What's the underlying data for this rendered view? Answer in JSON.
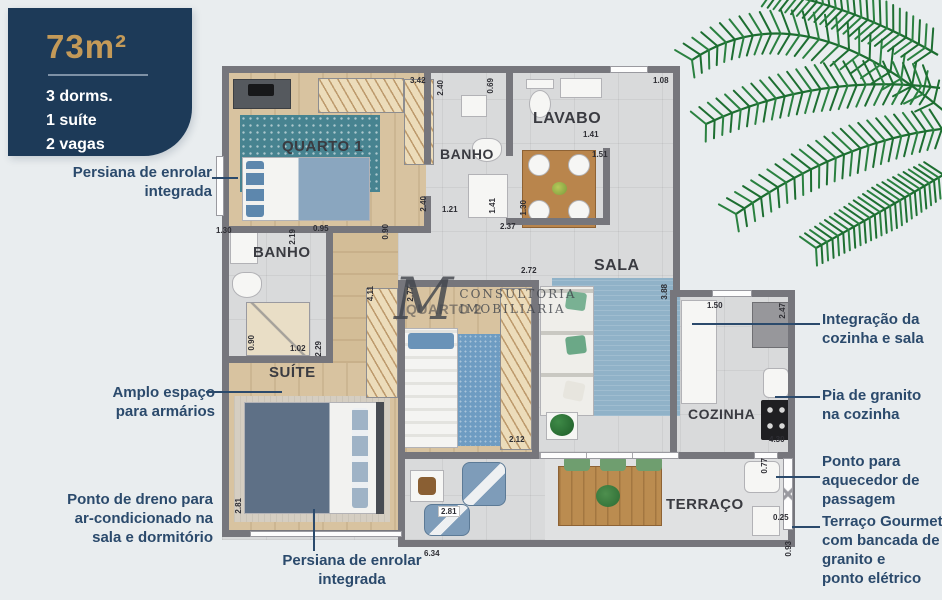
{
  "info_card": {
    "area_label": "73m²",
    "specs": [
      "3 dorms.",
      "1 suíte",
      "2 vagas"
    ]
  },
  "watermark": {
    "monogram": "M",
    "line1": "CONSULTORIA",
    "line2": "IMOBILIARIA"
  },
  "room_labels": [
    {
      "id": "quarto1",
      "text": "QUARTO 1",
      "x": 282,
      "y": 138,
      "size": 15
    },
    {
      "id": "banho-social",
      "text": "BANHO",
      "x": 440,
      "y": 146,
      "size": 14
    },
    {
      "id": "lavabo",
      "text": "LAVABO",
      "x": 533,
      "y": 110,
      "size": 16
    },
    {
      "id": "sala",
      "text": "SALA",
      "x": 594,
      "y": 257,
      "size": 16
    },
    {
      "id": "banho-suite",
      "text": "BANHO",
      "x": 253,
      "y": 244,
      "size": 15
    },
    {
      "id": "suite",
      "text": "SUÍTE",
      "x": 269,
      "y": 364,
      "size": 15
    },
    {
      "id": "quarto2",
      "text": "QUARTO 2",
      "x": 406,
      "y": 301,
      "size": 14,
      "faded": true
    },
    {
      "id": "cozinha",
      "text": "COZINHA",
      "x": 688,
      "y": 406,
      "size": 14
    },
    {
      "id": "terraco",
      "text": "TERRAÇO",
      "x": 666,
      "y": 496,
      "size": 15
    }
  ],
  "dimensions": [
    {
      "v": "3.42",
      "x": 410,
      "y": 76
    },
    {
      "v": "2.40",
      "x": 436,
      "y": 80,
      "r": 1
    },
    {
      "v": "0.69",
      "x": 486,
      "y": 78,
      "r": 1
    },
    {
      "v": "1.08",
      "x": 653,
      "y": 76
    },
    {
      "v": "1.41",
      "x": 583,
      "y": 130
    },
    {
      "v": "1.51",
      "x": 592,
      "y": 150
    },
    {
      "v": "2.40",
      "x": 419,
      "y": 196,
      "r": 1
    },
    {
      "v": "1.21",
      "x": 442,
      "y": 205
    },
    {
      "v": "1.41",
      "x": 488,
      "y": 198,
      "r": 1
    },
    {
      "v": "2.37",
      "x": 500,
      "y": 222
    },
    {
      "v": "1.30",
      "x": 519,
      "y": 200,
      "r": 1
    },
    {
      "v": "1.30",
      "x": 216,
      "y": 226
    },
    {
      "v": "2.19",
      "x": 288,
      "y": 229,
      "r": 1
    },
    {
      "v": "0.95",
      "x": 313,
      "y": 224
    },
    {
      "v": "0.90",
      "x": 381,
      "y": 224,
      "r": 1
    },
    {
      "v": "0.90",
      "x": 247,
      "y": 335,
      "r": 1
    },
    {
      "v": "1.02",
      "x": 290,
      "y": 344
    },
    {
      "v": "2.29",
      "x": 314,
      "y": 341,
      "r": 1
    },
    {
      "v": "4.11",
      "x": 366,
      "y": 286,
      "r": 1
    },
    {
      "v": "2.77",
      "x": 406,
      "y": 286,
      "r": 1
    },
    {
      "v": "2.72",
      "x": 521,
      "y": 266
    },
    {
      "v": "3.88",
      "x": 660,
      "y": 284,
      "r": 1
    },
    {
      "v": "1.50",
      "x": 707,
      "y": 301
    },
    {
      "v": "2.47",
      "x": 778,
      "y": 303,
      "r": 1
    },
    {
      "v": "4.30",
      "x": 769,
      "y": 435
    },
    {
      "v": "0.77",
      "x": 760,
      "y": 458,
      "r": 1
    },
    {
      "v": "0.25",
      "x": 773,
      "y": 513
    },
    {
      "v": "0.93",
      "x": 784,
      "y": 541,
      "r": 1
    },
    {
      "v": "2.81",
      "x": 234,
      "y": 498,
      "r": 1
    },
    {
      "v": "2.81",
      "x": 438,
      "y": 506,
      "badge": 1
    },
    {
      "v": "2.12",
      "x": 509,
      "y": 435
    },
    {
      "v": "6.34",
      "x": 424,
      "y": 549
    }
  ],
  "annotations": {
    "persiana_top": {
      "lines": [
        "Persiana de enrolar",
        "integrada"
      ]
    },
    "amplo": {
      "lines": [
        "Amplo espaço",
        "para armários"
      ]
    },
    "dreno": {
      "lines": [
        "Ponto de dreno para",
        "ar-condicionado na",
        "sala e dormitório"
      ]
    },
    "persiana_bottom": {
      "lines": [
        "Persiana de enrolar",
        "integrada"
      ]
    },
    "integracao": {
      "lines": [
        "Integração da",
        "cozinha e sala"
      ]
    },
    "pia": {
      "lines": [
        "Pia de granito",
        "na cozinha"
      ]
    },
    "aquecedor": {
      "lines": [
        "Ponto para",
        "aquecedor de",
        "passagem"
      ]
    },
    "terraco_gourmet": {
      "lines": [
        "Terraço Gourmet",
        "com bancada de",
        "granito e",
        "ponto elétrico"
      ]
    }
  },
  "colors": {
    "card_bg": "#1d3a58",
    "card_accent_gold": "#c49a58",
    "annotation_navy": "#2b4a6c",
    "wall_gray": "#76767c",
    "palm_green": "#1d6e31"
  }
}
